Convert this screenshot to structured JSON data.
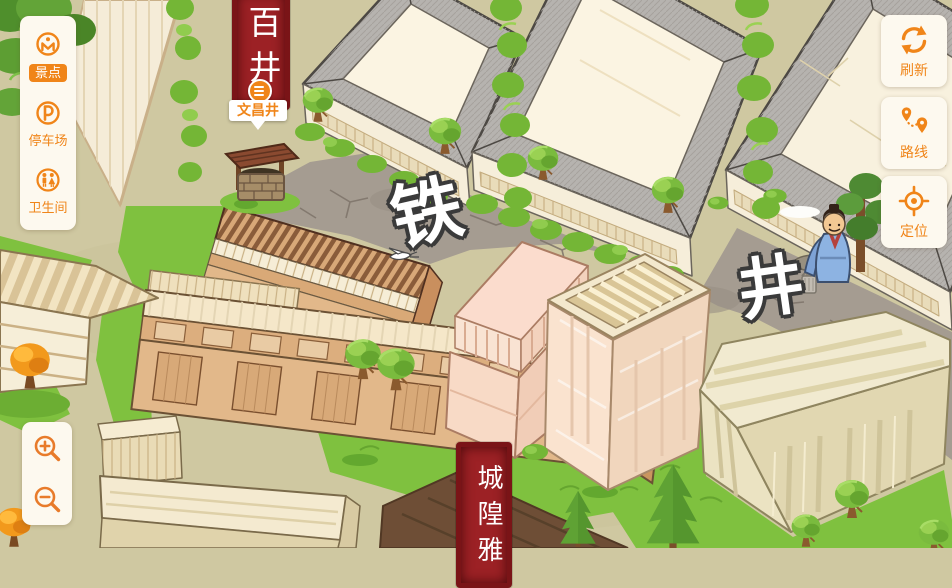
{
  "colors": {
    "accent": "#f08519",
    "banner_red": "#9c2125",
    "panel_bg": "#fdf9ef"
  },
  "sidebar": {
    "items": [
      {
        "label": "景点",
        "icon": "scenic-spot-icon",
        "selected": true
      },
      {
        "label": "停车场",
        "icon": "parking-icon",
        "selected": false
      },
      {
        "label": "卫生间",
        "icon": "restroom-icon",
        "selected": false
      }
    ]
  },
  "toolbar": {
    "buttons": [
      {
        "label": "刷新",
        "icon": "refresh-icon"
      },
      {
        "label": "路线",
        "icon": "route-icon"
      },
      {
        "label": "定位",
        "icon": "locate-icon"
      }
    ]
  },
  "zoom_controls": {
    "buttons": [
      {
        "icon": "zoom-in-icon"
      },
      {
        "icon": "zoom-out-icon"
      }
    ]
  },
  "map": {
    "street_labels": [
      {
        "text": "铁"
      },
      {
        "text": "井"
      }
    ],
    "poi_label": "文昌井",
    "banners": {
      "top": "百井",
      "bottom": "城隍雅"
    }
  }
}
